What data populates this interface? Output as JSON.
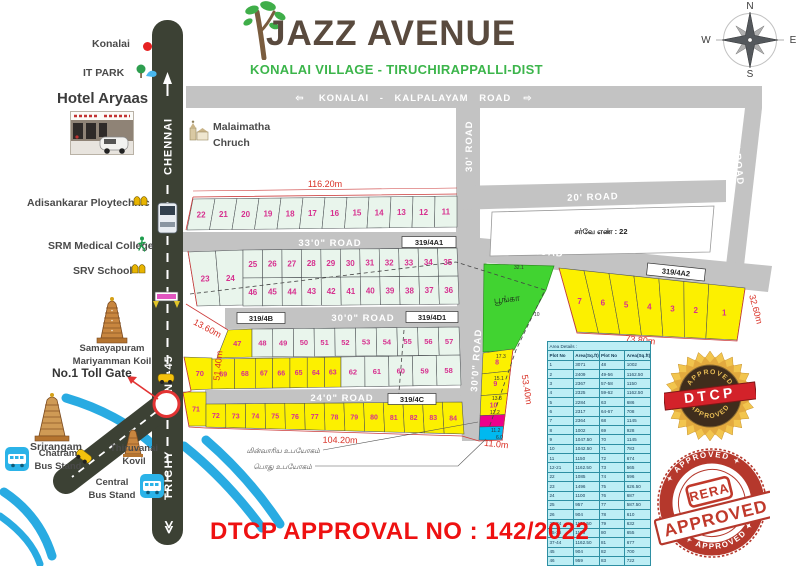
{
  "colors": {
    "road": "#c3c3c3",
    "roadText": "#ffffff",
    "highway": "#3c4134",
    "plotGreen": "#e9f5ec",
    "plotYellow": "#fcf000",
    "park": "#41d331",
    "magenta": "#ec008c",
    "cyan": "#00b9f0",
    "number": "#d6308f",
    "dim": "#d93025",
    "river": "#29abe2",
    "title": "#594a3e",
    "subtitle": "#3cb54b",
    "approval": "#ee1111",
    "stampGold": "#e9b93b",
    "stampRed": "#c23a2e",
    "boundary": "#cc3b3b",
    "tableBg": "#bdeef5"
  },
  "header": {
    "title": "JAZZ AVENUE",
    "subtitle": "KONALAI VILLAGE  - TIRUCHIRAPPALLI-DIST"
  },
  "compass": {
    "n": "N",
    "w": "W",
    "e": "E",
    "s": "S"
  },
  "banner": {
    "arrow_left": "⇦",
    "text": "KONALAI - KALPALAYAM ROAD",
    "arrow_right": "⇨"
  },
  "landmarks": {
    "konalai": "Konalai",
    "it_park": "IT PARK",
    "hotel": "Hotel Aryaas",
    "malaimatha_1": "Malaimatha",
    "malaimatha_2": "Chruch",
    "adisankarar": "Adisankarar Ploytechnic",
    "srm": "SRM Medical College",
    "srv": "SRV School",
    "samayapuram_1": "Samayapuram",
    "samayapuram_2": "Mariyamman Koil",
    "toll_gate": "No.1 Toll Gate",
    "srirangam": "Srirangam",
    "chatram_1": "Chatram",
    "chatram_2": "Bus Stand",
    "thiruvanai_1": "Thiruvanai",
    "thiruvanai_2": "Kovil",
    "central_1": "Central",
    "central_2": "Bus Stand"
  },
  "highway": {
    "chennai": "CHENNAI",
    "nh45": "NH-45",
    "trichy": "TRICHY",
    "chevrons": "≪"
  },
  "roads": {
    "r33": "33'0\" ROAD",
    "r33b": "33'0\" ROAD",
    "r30": "30'0\" ROAD",
    "r30v": "30'0\" ROAD",
    "r24": "24'0\" ROAD",
    "r20": "20' ROAD",
    "r25": "25' ROAD",
    "r30c": "30' ROAD"
  },
  "survey_boxes": {
    "a1": "319/4A1",
    "a2": "319/4A2",
    "b": "319/4B",
    "d1": "319/4D1",
    "c": "319/4C"
  },
  "survey_note": "சர்வே எண் : 22",
  "park_label": "பூங்கா",
  "dims": {
    "d116": "116.20m",
    "d43": "43.40m",
    "d13": "13.60m",
    "d51": "51.40m",
    "d104": "104.20m",
    "d73": "73.80m",
    "d32": "32.60m",
    "d53": "53.40m",
    "d11": "11.0m",
    "s321": "32.1",
    "s10": "10",
    "s173": "17.3",
    "s151": "15.1",
    "s138": "13.8",
    "s122": "12.2",
    "s112": "11.2",
    "s60": "6.0"
  },
  "annotations": {
    "tneb": "மின்வாரிய உபயோகம்",
    "public": "பொது உபயோகம்"
  },
  "approval_text": "DTCP APPROVAL NO : 142/2022",
  "stamps": {
    "dtcp": {
      "top": "APPROVED",
      "name": "DTCP",
      "bottom": "APPROVED"
    },
    "rera": {
      "top": "✦ APPROVED ✦",
      "name": "RERA",
      "banner": "APPROVED",
      "bottom": "✦ APPROVED ✦"
    }
  },
  "area_table": {
    "title": "Area Details :",
    "headers": [
      "Plot No",
      "Area(Sq.ft)",
      "Plot No",
      "Area(Sq.ft)"
    ],
    "rows": [
      [
        "1",
        "3071",
        "48",
        "1002"
      ],
      [
        "2",
        "2409",
        "49-56",
        "1162.50"
      ],
      [
        "3",
        "2367",
        "57-58",
        "1150"
      ],
      [
        "4",
        "2325",
        "59-62",
        "1162.50"
      ],
      [
        "5",
        "2284",
        "63",
        "686"
      ],
      [
        "6",
        "2317",
        "64-67",
        "708"
      ],
      [
        "7",
        "2364",
        "68",
        "1145"
      ],
      [
        "8",
        "1002",
        "69",
        "928"
      ],
      [
        "9",
        "1047.50",
        "70",
        "1145"
      ],
      [
        "10",
        "1042.50",
        "71",
        "783"
      ],
      [
        "11",
        "1150",
        "72",
        "674"
      ],
      [
        "12-21",
        "1162.50",
        "73",
        "565"
      ],
      [
        "22",
        "1085",
        "74",
        "596"
      ],
      [
        "23",
        "1496",
        "75",
        "626.50"
      ],
      [
        "24",
        "1100",
        "76",
        "687"
      ],
      [
        "25",
        "957",
        "77",
        "587.50"
      ],
      [
        "26",
        "904",
        "78",
        "610"
      ],
      [
        "27-34",
        "1162.50",
        "79",
        "632"
      ],
      [
        "35-36",
        "1150",
        "80",
        "655"
      ],
      [
        "37-44",
        "1162.50",
        "81",
        "677"
      ],
      [
        "45",
        "904",
        "82",
        "700"
      ],
      [
        "46",
        "959",
        "83",
        "722"
      ],
      [
        "47",
        "890",
        "84",
        "1054"
      ]
    ]
  },
  "layout": {
    "rows": {
      "rowA": [
        "22",
        "21",
        "20",
        "19",
        "18",
        "17",
        "16",
        "15",
        "14",
        "13",
        "12",
        "11"
      ],
      "row2324": [
        "23",
        "24"
      ],
      "rowB2": [
        "25",
        "26",
        "27",
        "28",
        "29",
        "30",
        "31",
        "32",
        "33",
        "34",
        "35"
      ],
      "rowB3": [
        "46",
        "45",
        "44",
        "43",
        "42",
        "41",
        "40",
        "39",
        "38",
        "37",
        "36"
      ],
      "rowC1y": [
        "47"
      ],
      "rowC1g": [
        "48",
        "49",
        "50",
        "51",
        "52",
        "53",
        "54",
        "55",
        "56",
        "57"
      ],
      "plot70": [
        "70"
      ],
      "rowC2y": [
        "69",
        "68",
        "67",
        "66",
        "65",
        "64",
        "63"
      ],
      "rowC2g": [
        "62",
        "61",
        "60",
        "59",
        "58"
      ],
      "plot71": [
        "71"
      ],
      "rowD": [
        "72",
        "73",
        "74",
        "75",
        "76",
        "77",
        "78",
        "79",
        "80",
        "81",
        "82",
        "83",
        "84"
      ],
      "row17": [
        "7",
        "6",
        "5",
        "4",
        "3",
        "2",
        "1"
      ]
    },
    "right_column": [
      {
        "label": "8",
        "color": "plotYellow"
      },
      {
        "label": "9",
        "color": "plotYellow"
      },
      {
        "label": "10",
        "color": "plotYellow"
      },
      {
        "label": "",
        "color": "magenta"
      },
      {
        "label": "",
        "color": "cyan"
      }
    ]
  }
}
